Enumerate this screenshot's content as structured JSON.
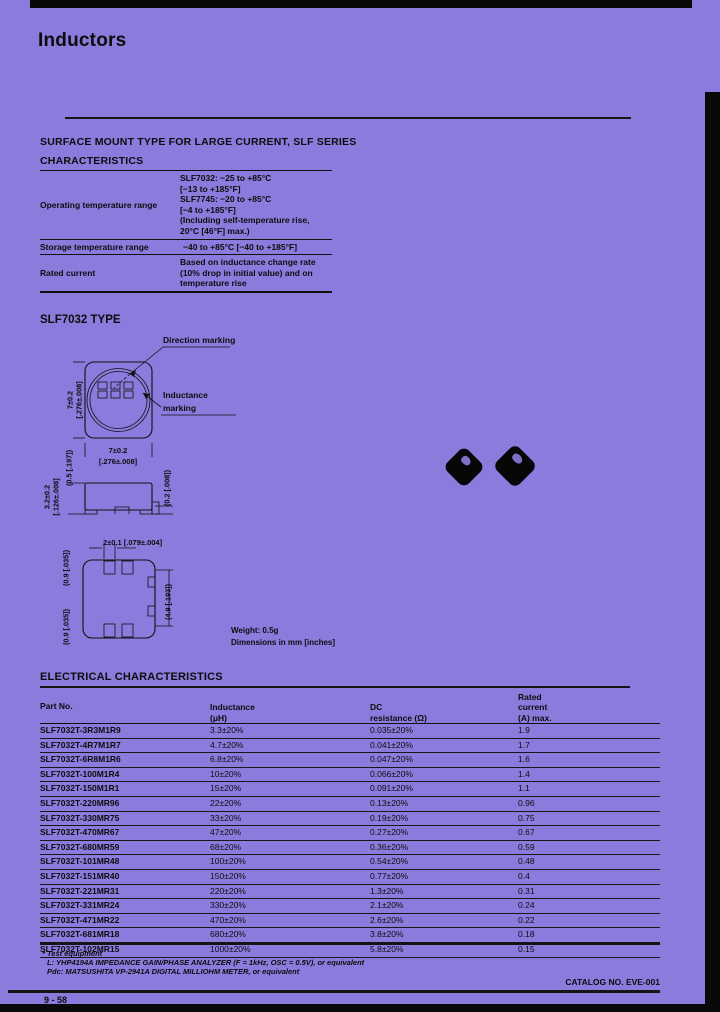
{
  "page": {
    "title": "Inductors",
    "page_number": "9 - 58",
    "catalog_label": "CATALOG NO. EVE-001"
  },
  "characteristics": {
    "section_heading": "SURFACE MOUNT TYPE FOR LARGE CURRENT, SLF SERIES",
    "heading": "CHARACTERISTICS",
    "rows": [
      {
        "label": "Operating temperature range",
        "lines": [
          "SLF7032: −25 to +85°C",
          "[−13 to +185°F]",
          "SLF7745: −20 to +85°C",
          "[−4 to +185°F]",
          "(Including self-temperature rise,",
          "20°C [46°F] max.)"
        ]
      },
      {
        "label": "Storage temperature range",
        "lines": [
          "−40 to +85°C [−40 to +185°F]"
        ]
      },
      {
        "label": "Rated current",
        "lines": [
          "Based on inductance change rate",
          "(10% drop in initial value) and on",
          "temperature rise"
        ]
      }
    ]
  },
  "drawing": {
    "heading": "SLF7032 TYPE",
    "direction_marking_label": "Direction marking",
    "inductance_marking_lines": [
      "Inductance",
      "marking"
    ],
    "dims": {
      "top_left_mm": "7±0.2",
      "top_left_in": "[.276±.008]",
      "top_bottom_mm": "7±0.2",
      "top_bottom_in": "[.276±.008]",
      "side_left_top": "(0.5 [.197])",
      "side_left_mm": "3.2±0.2",
      "side_left_in": "[.126±.008]",
      "side_right": "(0.2 [.008])",
      "bottom_top": "2±0.1 [.079±.004]",
      "bottom_left_upper": "(0.9 [.035])",
      "bottom_left_lower": "(0.9 [.035])",
      "bottom_right": "(4.9 [.193])"
    },
    "weight_note": "Weight: 0.5g",
    "dimensions_note": "Dimensions in mm [inches]"
  },
  "electrical": {
    "heading": "ELECTRICAL CHARACTERISTICS",
    "columns": {
      "part": "Part No.",
      "inductance": [
        "Inductance",
        "(μH)"
      ],
      "dc": [
        "DC",
        "resistance (Ω)"
      ],
      "rated": [
        "Rated",
        "current",
        "(A) max."
      ]
    },
    "rows": [
      {
        "part": "SLF7032T-3R3M1R9",
        "inductance": "3.3±20%",
        "dc": "0.035±20%",
        "rated": "1.9"
      },
      {
        "part": "SLF7032T-4R7M1R7",
        "inductance": "4.7±20%",
        "dc": "0.041±20%",
        "rated": "1.7"
      },
      {
        "part": "SLF7032T-6R8M1R6",
        "inductance": "6.8±20%",
        "dc": "0.047±20%",
        "rated": "1.6"
      },
      {
        "part": "SLF7032T-100M1R4",
        "inductance": "10±20%",
        "dc": "0.066±20%",
        "rated": "1.4"
      },
      {
        "part": "SLF7032T-150M1R1",
        "inductance": "15±20%",
        "dc": "0.091±20%",
        "rated": "1.1"
      },
      {
        "part": "SLF7032T-220MR96",
        "inductance": "22±20%",
        "dc": "0.13±20%",
        "rated": "0.96"
      },
      {
        "part": "SLF7032T-330MR75",
        "inductance": "33±20%",
        "dc": "0.19±20%",
        "rated": "0.75"
      },
      {
        "part": "SLF7032T-470MR67",
        "inductance": "47±20%",
        "dc": "0.27±20%",
        "rated": "0.67"
      },
      {
        "part": "SLF7032T-680MR59",
        "inductance": "68±20%",
        "dc": "0.36±20%",
        "rated": "0.59"
      },
      {
        "part": "SLF7032T-101MR48",
        "inductance": "100±20%",
        "dc": "0.54±20%",
        "rated": "0.48"
      },
      {
        "part": "SLF7032T-151MR40",
        "inductance": "150±20%",
        "dc": "0.77±20%",
        "rated": "0.4"
      },
      {
        "part": "SLF7032T-221MR31",
        "inductance": "220±20%",
        "dc": "1.3±20%",
        "rated": "0.31"
      },
      {
        "part": "SLF7032T-331MR24",
        "inductance": "330±20%",
        "dc": "2.1±20%",
        "rated": "0.24"
      },
      {
        "part": "SLF7032T-471MR22",
        "inductance": "470±20%",
        "dc": "2.6±20%",
        "rated": "0.22"
      },
      {
        "part": "SLF7032T-681MR18",
        "inductance": "680±20%",
        "dc": "3.8±20%",
        "rated": "0.18"
      },
      {
        "part": "SLF7032T-102MR15",
        "inductance": "1000±20%",
        "dc": "5.8±20%",
        "rated": "0.15"
      }
    ]
  },
  "footnotes": {
    "line1": "* Test equipment",
    "line2": "L: YHP4194A IMPEDANCE GAIN/PHASE ANALYZER (F = 1kHz, OSC = 0.5V), or equivalent",
    "line3": "Pdc: MATSUSHITA VP-2941A DIGITAL MILLIOHM METER, or equivalent"
  }
}
